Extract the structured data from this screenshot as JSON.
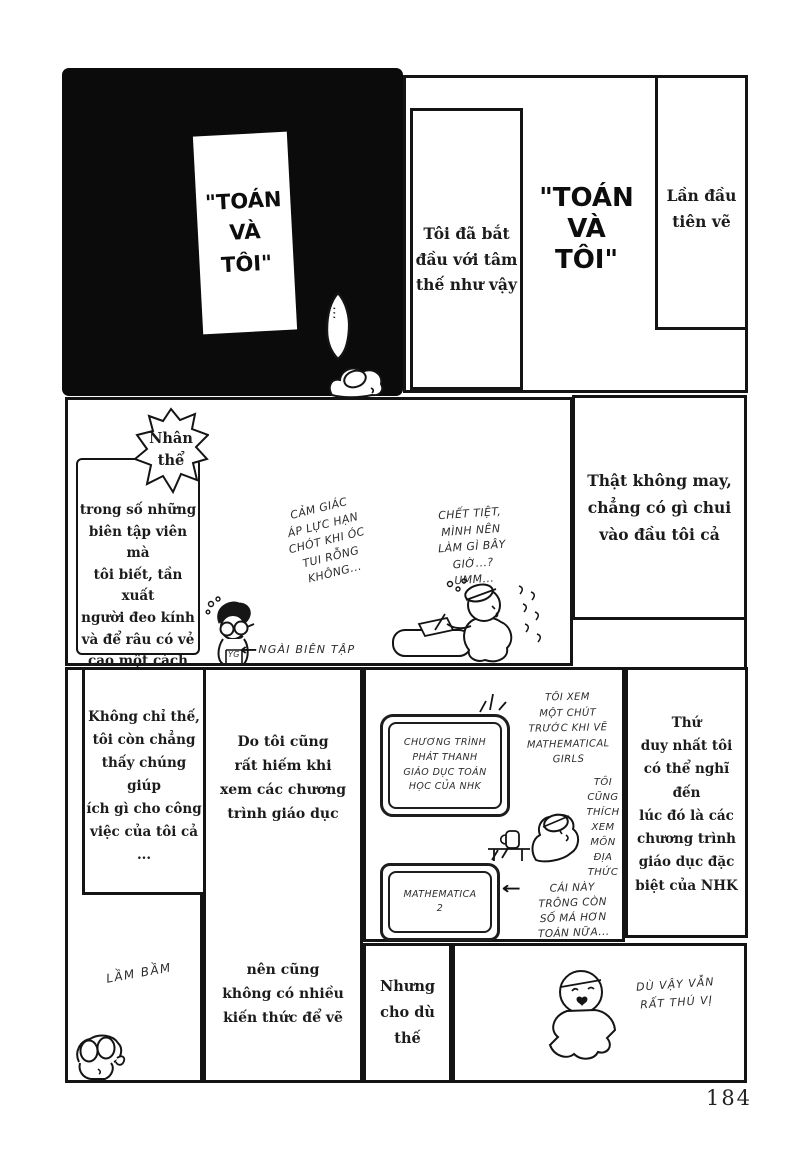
{
  "page_number": "184",
  "panel1": {
    "sign": "\"TOÁN\nVÀ\nTÔI\"",
    "bubble_dots": "..."
  },
  "panel2": {
    "caption_left": "Tôi đã bắt\nđầu với tâm\nthế như vậy",
    "title": "\"TOÁN\nVÀ\nTÔI\"",
    "caption_right": "Lần đầu\ntiên vẽ"
  },
  "panel3": {
    "burst": "Nhân\nthể",
    "caption": "trong số những\nbiên tập viên mà\ntôi biết, tần xuất\nngười đeo kính\nvà để râu có vẻ\ncao một cách kỳ lạ...",
    "note_pressure": "CẢM GIÁC\nÁP LỰC HẠN\nCHÓT KHI ÓC\nTUI RỖNG\nKHÔNG...",
    "note_damn": "CHẾT TIỆT,\nMÌNH NÊN\nLÀM GÌ BÂY\nGIỜ...?\nUMM...",
    "arrow": "←",
    "editor_label": "NGÀI BIÊN TẬP",
    "editor_tag": "YG"
  },
  "panel4": {
    "caption": "Thật không may,\nchẳng có gì chui\nvào đầu tôi cả"
  },
  "panel5": {
    "caption": "Không chỉ thế,\ntôi còn chẳng\nthấy chúng giúp\ních gì cho công\nviệc của tôi cả\n...",
    "mutter": "LẦM BẦM"
  },
  "panel6": {
    "caption_top": "Do tôi cũng\nrất hiếm khi\nxem các chương\ntrình giáo dục",
    "caption_bottom": "nên cũng\nkhông có nhiều\nkiến thức để vẽ"
  },
  "panel7": {
    "tv1": "CHƯƠNG TRÌNH\nPHÁT THANH\nGIÁO DỤC TOÁN\nHỌC CỦA NHK",
    "tv2": "MATHEMATICA\n2",
    "note_watch": "TÔI XEM\nMỘT CHÚT\nTRƯỚC KHI VẼ\nMATHEMATICAL\nGIRLS",
    "note_also": "TÔI\nCŨNG\nTHÍCH\nXEM\nMÔN\nĐỊA\nTHỨC",
    "arrow": "←",
    "note_numbers": "CÁI NÀY\nTRÔNG CÒN\nSỐ MÁ HƠN\nTOÁN NỮA..."
  },
  "panel8": {
    "caption": "Thứ\nduy nhất tôi\ncó thể nghĩ đến\nlúc đó là các\nchương trình\ngiáo dục đặc\nbiệt của NHK"
  },
  "panel9": {
    "caption": "Nhưng\ncho dù\nthế"
  },
  "panel10": {
    "note_fun": "DÙ VẬY VẪN\nRẤT THÚ VỊ"
  },
  "colors": {
    "ink": "#141414",
    "paper": "#ffffff"
  }
}
